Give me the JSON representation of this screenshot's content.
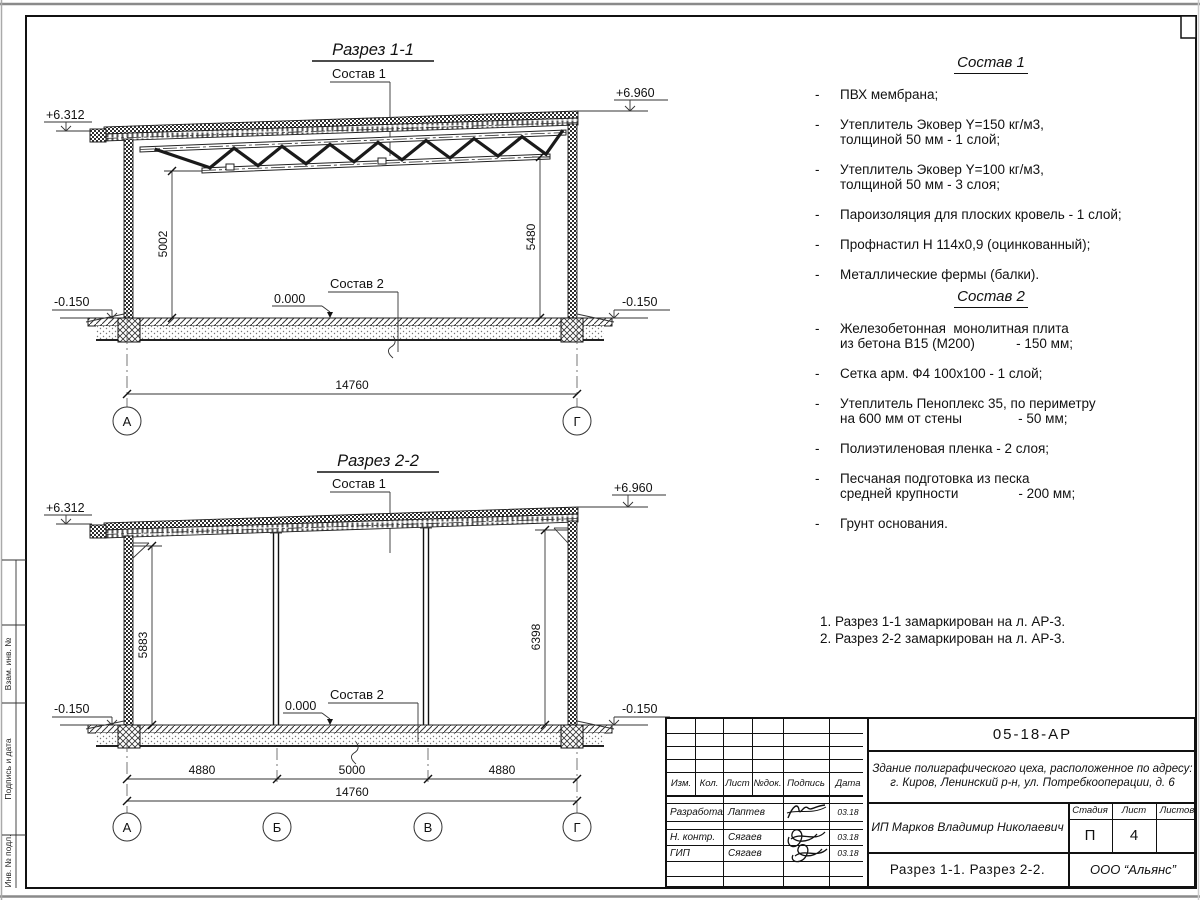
{
  "list_bullet": "-",
  "frame": {
    "side_labels": [
      "Взам. инв. №",
      "Подпись и дата",
      "Инв. № подл."
    ]
  },
  "section1": {
    "title": "Разрез 1-1",
    "composition1_label": "Состав 1",
    "composition2_label": "Состав 2",
    "elev_left_top": "+6.312",
    "elev_right_top": "+6.960",
    "elev_left_bottom": "-0.150",
    "elev_right_bottom": "-0.150",
    "elev_zero": "0.000",
    "dim_height_left": "5002",
    "dim_height_right": "5480",
    "dim_width_total": "14760",
    "axis_left": "А",
    "axis_right": "Г"
  },
  "section2": {
    "title": "Разрез 2-2",
    "composition1_label": "Состав 1",
    "composition2_label": "Состав 2",
    "elev_left_top": "+6.312",
    "elev_right_top": "+6.960",
    "elev_left_bottom": "-0.150",
    "elev_right_bottom": "-0.150",
    "elev_zero": "0.000",
    "dim_height_left": "5883",
    "dim_height_right": "6398",
    "dim_spans": [
      "4880",
      "5000",
      "4880"
    ],
    "dim_width_total": "14760",
    "axes": [
      "А",
      "Б",
      "В",
      "Г"
    ]
  },
  "composition1": {
    "title": "Состав 1",
    "items": [
      [
        "ПВХ мембрана;"
      ],
      [
        "Утеплитель Эковер Y=150 кг/м3,",
        "толщиной 50 мм - 1 слой;"
      ],
      [
        "Утеплитель Эковер Y=100 кг/м3,",
        "толщиной 50 мм - 3 слоя;"
      ],
      [
        "Пароизоляция для плоских кровель - 1 слой;"
      ],
      [
        "Профнастил Н 114х0,9 (оцинкованный);"
      ],
      [
        "Металлические фермы (балки)."
      ]
    ]
  },
  "composition2": {
    "title": "Состав 2",
    "items": [
      [
        "Железобетонная  монолитная плита",
        "из бетона В15 (М200)           - 150 мм;"
      ],
      [
        "Сетка арм. Ф4 100х100 - 1 слой;"
      ],
      [
        "Утеплитель Пеноплекс 35, по периметру",
        "на 600 мм от стены               - 50 мм;"
      ],
      [
        "Полиэтиленовая пленка - 2 слоя;"
      ],
      [
        "Песчаная подготовка из песка",
        "средней крупности                - 200 мм;"
      ],
      [
        "Грунт основания."
      ]
    ]
  },
  "notes": [
    "1. Разрез 1-1 замаркирован на л. АР-3.",
    "2. Разрез 2-2 замаркирован на л. АР-3."
  ],
  "titleblock": {
    "doc_number": "05-18-АР",
    "object_line1": "Здание полиграфического цеха, расположенное по адресу:",
    "object_line2": "г. Киров,  Ленинский р-н, ул. Потребкооперации, д. 6",
    "client": "ИП Марков Владимир Николаевич",
    "sheet_title": "Разрез 1-1. Разрез 2-2.",
    "company": "ООО “Альянс”",
    "cols": [
      "Изм.",
      "Кол.",
      "Лист",
      "№док.",
      "Подпись",
      "Дата"
    ],
    "stage_label": "Стадия",
    "sheet_label": "Лист",
    "sheets_label": "Листов",
    "stage": "П",
    "sheet": "4",
    "sheets": "",
    "rows": [
      {
        "role": "Разработал",
        "name": "Лаптев",
        "date": "03.18"
      },
      {
        "role": "Н. контр.",
        "name": "Сягаев",
        "date": "03.18"
      },
      {
        "role": "ГИП",
        "name": "Сягаев",
        "date": "03.18"
      }
    ]
  }
}
